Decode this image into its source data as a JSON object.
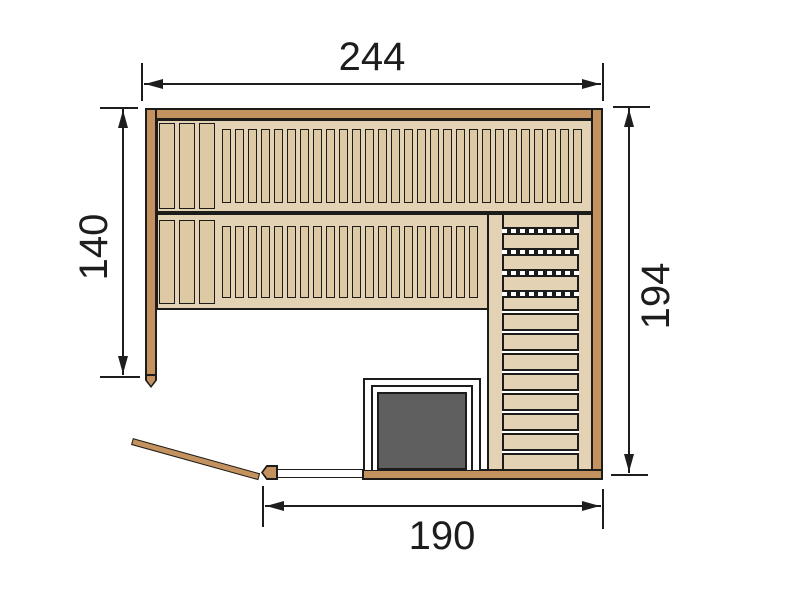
{
  "dimensions": {
    "top": "244",
    "left": "140",
    "right": "194",
    "bottom": "190"
  },
  "colors": {
    "background": "#ffffff",
    "wall": "#c3925e",
    "deck": "#e3d2b3",
    "slat": "#ddc9a4",
    "outline": "#1c1c1b",
    "heater": "#5f5f5f",
    "dim": "#1d1d1d"
  },
  "figure": {
    "benches": [
      {
        "name": "upper-bench-wide-slats",
        "x": 159,
        "y": 123,
        "slat_w": 16,
        "slat_h": 86,
        "gap": 4,
        "count": 3
      },
      {
        "name": "upper-bench-narrow-slats",
        "x": 222,
        "y": 129,
        "slat_w": 9,
        "slat_h": 74,
        "gap": 4,
        "count": 28
      },
      {
        "name": "lower-bench-wide-slats",
        "x": 159,
        "y": 220,
        "slat_w": 16,
        "slat_h": 84,
        "gap": 4,
        "count": 3
      },
      {
        "name": "lower-bench-narrow-slats",
        "x": 222,
        "y": 226,
        "slat_w": 9,
        "slat_h": 72,
        "gap": 4,
        "count": 20
      }
    ],
    "right_column": {
      "dashed_rows": {
        "x": 502,
        "w": 77,
        "y_start": 227,
        "spacing": 21,
        "count": 4,
        "h": 8
      },
      "gap_rows": {
        "x": 502,
        "w": 77,
        "y_start": 309,
        "spacing": 20,
        "count": 8,
        "h": 6
      }
    }
  }
}
